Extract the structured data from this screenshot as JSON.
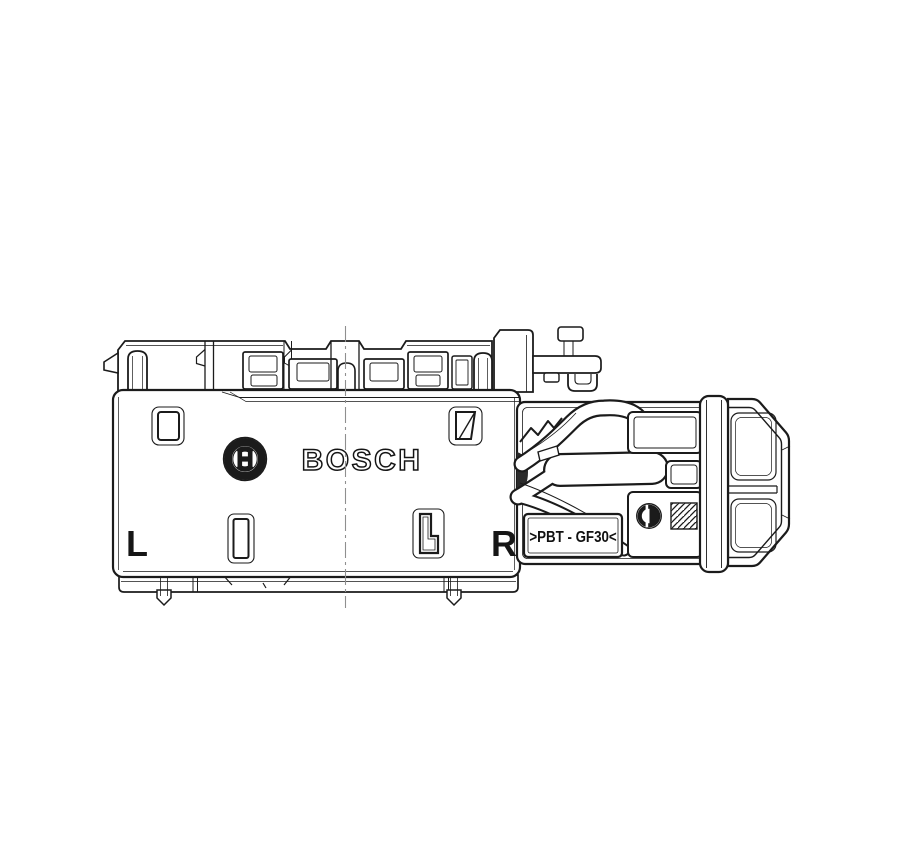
{
  "page": {
    "background": "#ffffff",
    "kind": "technical-line-drawing"
  },
  "drawing": {
    "line_color": "#1b1b1b",
    "thin_line_color": "#3a3a3a",
    "centerline_color": "#8f8f8f",
    "housing": {
      "brand": "BOSCH",
      "left_marking": "L",
      "right_marking": "R"
    },
    "lever": {
      "material_marking": ">PBT - GF30<"
    },
    "symbols": {
      "emblem": "bosch-anchor-emblem",
      "material_dot": "material-id-symbol",
      "hatch": "hatch-pattern-square"
    }
  }
}
